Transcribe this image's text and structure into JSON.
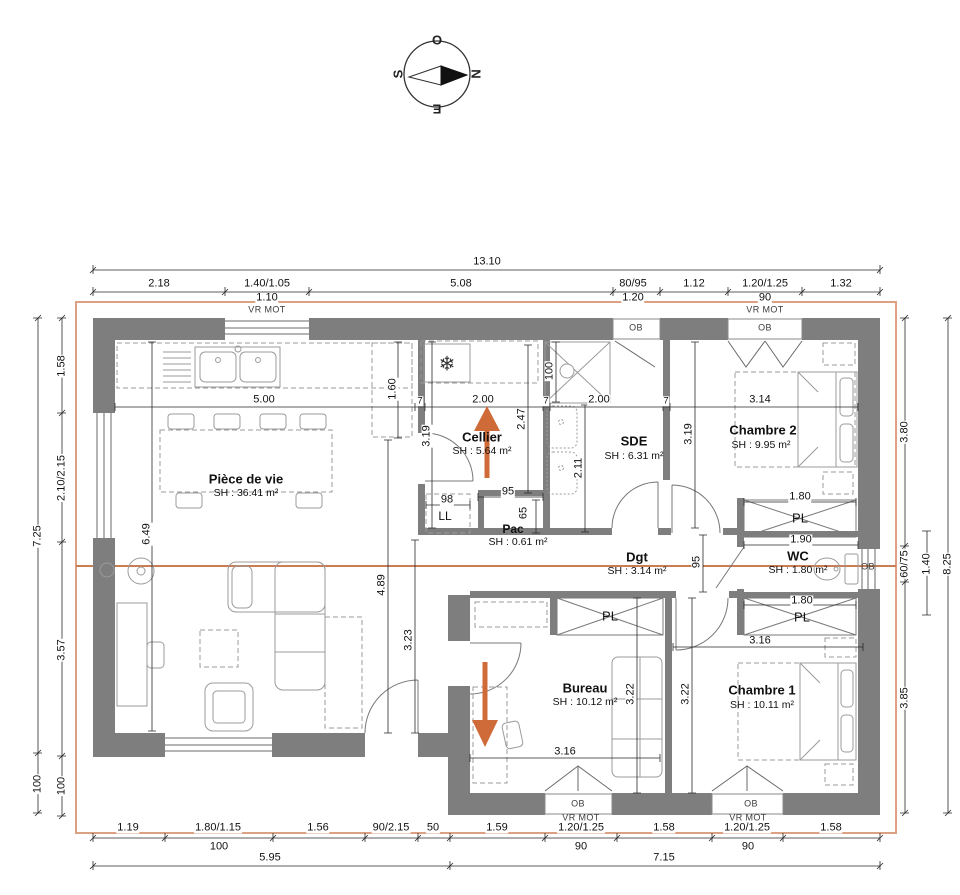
{
  "compass": {
    "west": "O",
    "north": "N",
    "south": "S",
    "east": "E"
  },
  "colors": {
    "wall": "#7E7E7E",
    "overhang": "#DCA183",
    "section_line": "#C87E52",
    "arrow": "#CE6B38"
  },
  "rooms": {
    "piece_de_vie": {
      "name": "Pièce de vie",
      "area": "SH : 36.41 m²"
    },
    "cellier": {
      "name": "Cellier",
      "area": "SH : 5.64 m²"
    },
    "pac": {
      "name": "Pac",
      "area": "SH : 0.61 m²"
    },
    "sde": {
      "name": "SDE",
      "area": "SH : 6.31 m²"
    },
    "chambre2": {
      "name": "Chambre 2",
      "area": "SH : 9.95 m²"
    },
    "dgt": {
      "name": "Dgt",
      "area": "SH : 3.14 m²"
    },
    "wc": {
      "name": "WC",
      "area": "SH : 1.80 m²"
    },
    "bureau": {
      "name": "Bureau",
      "area": "SH : 10.12 m²"
    },
    "chambre1": {
      "name": "Chambre 1",
      "area": "SH : 10.11 m²"
    }
  },
  "dims_top": {
    "total": "13.10",
    "s1": "2.18",
    "s2": "1.40/1.05",
    "s3": "5.08",
    "s4": "80/95",
    "s5": "1.12",
    "s6": "1.20/1.25",
    "s7": "1.32",
    "o1": "1.10",
    "o2": "1.20",
    "o3": "90"
  },
  "dims_bottom": {
    "s1": "1.19",
    "s2": "1.80/1.15",
    "s3": "1.56",
    "s4": "90/2.15",
    "s5": "50",
    "s6": "1.59",
    "s7": "1.20/1.25",
    "s8": "1.58",
    "s9": "1.20/1.25",
    "s10": "1.58",
    "o1": "100",
    "o2": "90",
    "o3": "90",
    "t1": "5.95",
    "t2": "7.15"
  },
  "dims_left": {
    "t1": "7.25",
    "t2": "100",
    "s1": "1.58",
    "s2": "2.10/2.15",
    "s3": "3.57",
    "s4": "100"
  },
  "dims_right": {
    "s1": "3.80",
    "s2": "60/75",
    "s3": "3.85",
    "w": "1.40",
    "total": "8.25"
  },
  "dims_interior": {
    "kitchen_w": "5.00",
    "part": "7",
    "cellier_w": "2.00",
    "sde_w": "2.00",
    "ch2_w": "3.14",
    "counter": "1.60",
    "cellier_h": "3.19",
    "cellier_h2": "2.47",
    "shower": "100",
    "sink": "2.11",
    "ch2_h": "3.19",
    "living_h": "6.49",
    "living_h2": "4.89",
    "living_h3": "3.23",
    "dgt_w": "95",
    "pac_w": "95",
    "pac_h": "65",
    "ll_w": "98",
    "ch2_pl": "1.80",
    "wc_w": "1.90",
    "ch1_pl": "1.80",
    "ch1_w": "3.16",
    "bureau_w": "3.16",
    "bureau_h": "3.22",
    "ch1_h": "3.22"
  },
  "labels": {
    "vr_mot": "VR MOT",
    "ob": "OB",
    "pl": "PL",
    "ll": "LL",
    "snowflake": "❄"
  }
}
